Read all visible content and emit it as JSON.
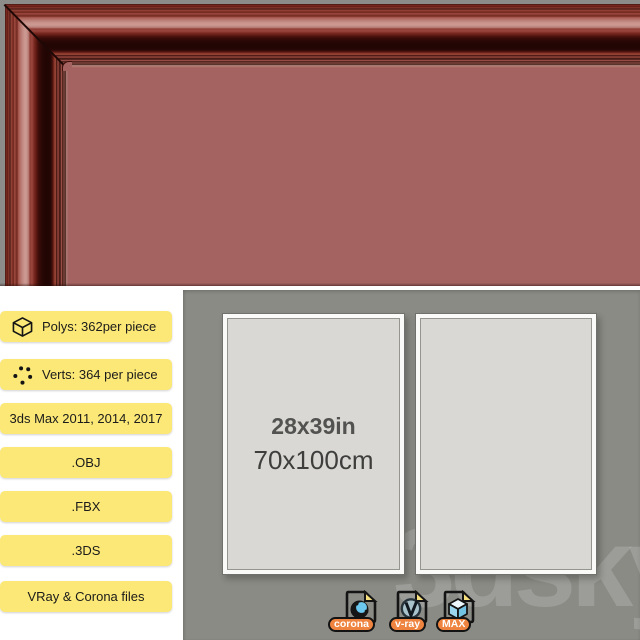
{
  "specs": {
    "items": [
      {
        "icon": "cube-icon",
        "label": "Polys: 362per piece"
      },
      {
        "icon": "verts-dots-icon",
        "label": "Verts: 364 per piece"
      },
      {
        "label": "3ds Max 2011, 2014, 2017"
      },
      {
        "label": ".OBJ"
      },
      {
        "label": ".FBX"
      },
      {
        "label": ".3DS"
      },
      {
        "label": "VRay & Corona files"
      }
    ]
  },
  "preview": {
    "poster_size_in": "28x39in",
    "poster_size_cm": "70x100cm",
    "watermark": "3dsky",
    "file_formats": [
      {
        "icon": "corona-file-icon",
        "label": "corona"
      },
      {
        "icon": "vray-file-icon",
        "label": "v-ray"
      },
      {
        "icon": "max-file-icon",
        "label": "MAX"
      }
    ]
  },
  "colors": {
    "frame_red": "#a46361",
    "panel_gray": "#8b8b86",
    "badge_yellow": "#fce876",
    "format_orange": "#ee8440",
    "logo_blue": "#6cc8ef",
    "canvas_gray": "#d9d8d4"
  }
}
